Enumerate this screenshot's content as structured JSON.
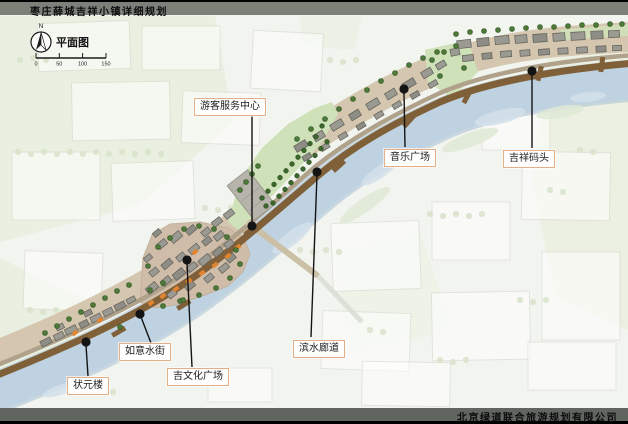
{
  "header": {
    "title": "枣庄薛城吉祥小镇详细规划"
  },
  "footer": {
    "company": "北京绿道联合旅游规划有限公司"
  },
  "legend": {
    "north": "N",
    "view_label": "平面图",
    "scale_ticks": [
      "0",
      "50",
      "100",
      "150"
    ]
  },
  "map": {
    "labels": [
      {
        "id": "visitor-center",
        "text": "游客服务中心"
      },
      {
        "id": "music-plaza",
        "text": "音乐广场"
      },
      {
        "id": "jixiang-wharf",
        "text": "吉祥码头"
      },
      {
        "id": "waterfront-corridor",
        "text": "滨水廊道"
      },
      {
        "id": "ruyi-water-street",
        "text": "如意水街"
      },
      {
        "id": "ji-culture-plaza",
        "text": "吉文化广场"
      },
      {
        "id": "zhuangyuan-tower",
        "text": "状元楼"
      }
    ]
  },
  "colors": {
    "bar_gray_top": "#7b8078",
    "bar_gray_bottom": "#60655f",
    "river": "#bed2e1",
    "promenade": "#7f6038",
    "town_ground": "#d5c7af",
    "town_core": "#cfbda9",
    "lawn": "#cfe1b8",
    "tree": "#4d7939",
    "accent_orange": "#e08430",
    "callout_border": "#e4ae87"
  }
}
